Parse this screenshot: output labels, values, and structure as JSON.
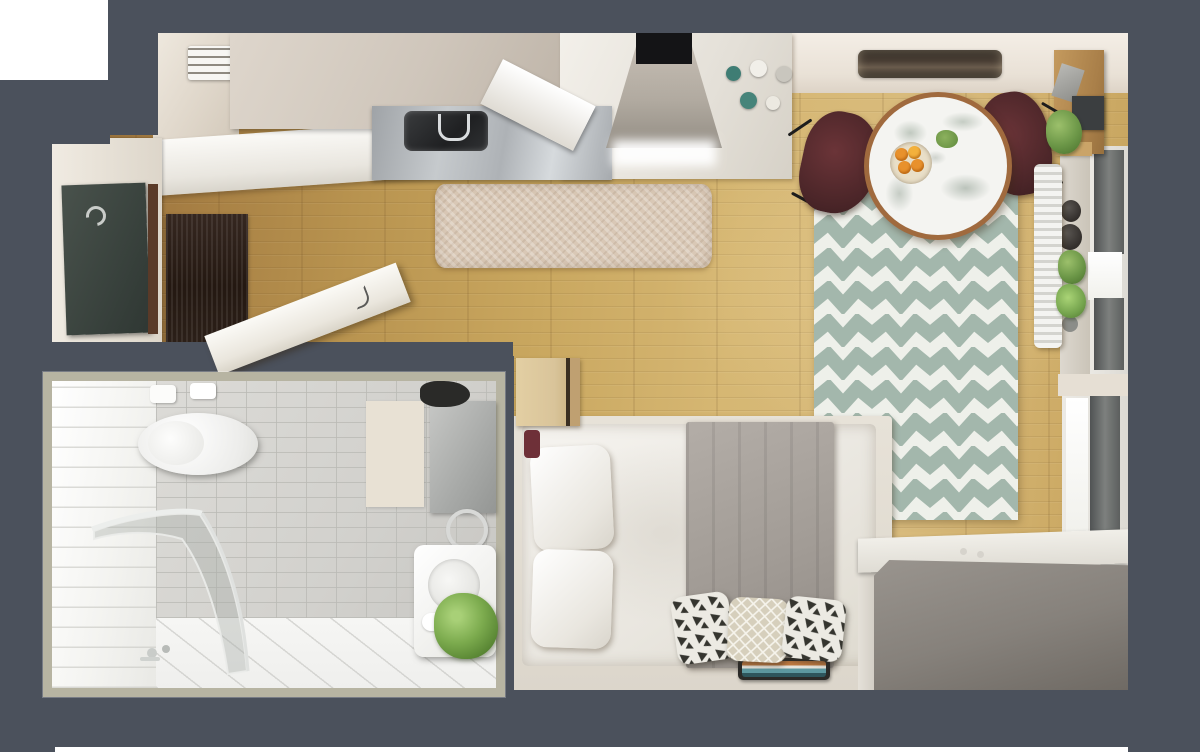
{
  "scene": {
    "description": "photorealistic top-down 3d render of a studio apartment floor plan",
    "view": "top-down orthographic render, no visible text or labels"
  },
  "palette": {
    "wall": "#4b515c",
    "exterior": "#ffffff",
    "floor_light": "#d7bb7d",
    "floor_dark": "#946d39",
    "rug_beige": "#d9c8b6",
    "chevron_green": "#a3b7ac",
    "chevron_white": "#eef0ea",
    "cabinet_beige": "#d2c9bf",
    "counter_white": "#f1efeb",
    "steel": "#b9bdc1",
    "table_wood": "#a06a3e",
    "marble": "#f4f4f1",
    "marble_vein": "#9aa89c",
    "chair_maroon": "#55282b",
    "oranges": "#e8912c",
    "plant_green": "#7fae57",
    "curtain_gray": "#6f7270",
    "shelf_wood": "#b98b52",
    "bed_white": "#f2f0ec",
    "blanket_gray": "#a59f99",
    "platform_cream": "#dfdad0",
    "cushion_dark": "#35352f",
    "cushion_net": "#d6cfbc",
    "tray_teal": "#5d98a0",
    "tray_orange": "#c27a40",
    "desk_gray": "#8d8883",
    "door_dark": "#3e4540",
    "mat_brown": "#2c2019",
    "bath_border": "#b7b4a2",
    "bath_tile_gray": "#d5d4d0",
    "bath_floor": "#f4f4f2",
    "towel_beige": "#e8e1d4",
    "washer_white": "#fafaf8"
  },
  "rooms": [
    {
      "name": "kitchen",
      "objects": [
        "wall-cabinets",
        "air-conditioner",
        "stainless-sink",
        "faucet",
        "open-dishwasher-door",
        "range-hood",
        "cooktop-light",
        "spice-jars",
        "beige-shag-rug"
      ]
    },
    {
      "name": "dining-area",
      "objects": [
        "round-marble-table",
        "fruit-bowl-with-oranges",
        "succulent-sprig",
        "maroon-chair-left",
        "maroon-chair-right",
        "ceiling-light-fixture",
        "chevron-rug"
      ]
    },
    {
      "name": "entry",
      "objects": [
        "entry-door",
        "door-handle",
        "door-mat",
        "open-white-door"
      ]
    },
    {
      "name": "window-wall",
      "objects": [
        "wood-shelf-unit",
        "hanging-plant",
        "radiator",
        "window-upper",
        "window-lower",
        "gray-curtains",
        "sill-vases",
        "sill-plants"
      ]
    },
    {
      "name": "sleeping-area",
      "objects": [
        "bed-frame",
        "mattress-duvet",
        "white-pillows",
        "gray-blanket",
        "patterned-cushions",
        "striped-tray",
        "wood-nightstand",
        "gray-desk-bench"
      ]
    },
    {
      "name": "bathroom-inset",
      "objects": [
        "toilet",
        "flush-plate",
        "toilet-paper",
        "curved-glass-shower",
        "floor-faucet",
        "bath-mat",
        "mirror-cabinet",
        "towel-ring",
        "washing-machine",
        "green-plant",
        "dark-plant"
      ]
    }
  ]
}
